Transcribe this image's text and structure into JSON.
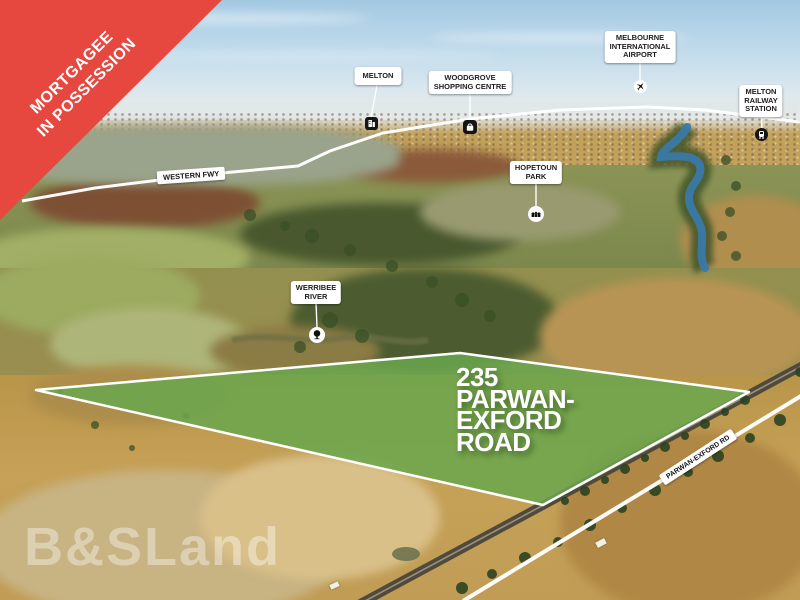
{
  "banner": {
    "lines": [
      "MORTGAGEE",
      "IN POSSESSION"
    ],
    "color": "#e64840"
  },
  "callouts": {
    "melton": {
      "lines": [
        "MELTON"
      ],
      "icon": "building-icon"
    },
    "woodgrove": {
      "lines": [
        "WOODGROVE",
        "SHOPPING CENTRE"
      ],
      "icon": "shopping-bag-icon"
    },
    "airport": {
      "lines": [
        "MELBOURNE",
        "INTERNATIONAL",
        "AIRPORT"
      ],
      "icon": "airplane-icon"
    },
    "melton_railway": {
      "lines": [
        "MELTON",
        "RAILWAY",
        "STATION"
      ],
      "icon": "train-icon"
    },
    "hopetoun_park": {
      "lines": [
        "HOPETOUN",
        "PARK"
      ],
      "icon": "houses-icon"
    },
    "werribee_river": {
      "lines": [
        "WERRIBEE",
        "RIVER"
      ],
      "icon": "tree-icon"
    }
  },
  "road_labels": {
    "western_fwy": "WESTERN FWY",
    "parwan_exford": "PARWAN-EXFORD RD"
  },
  "property": {
    "address_lines": [
      "235",
      "PARWAN-",
      "EXFORD",
      "ROAD"
    ],
    "highlight_color": "#6aa74e",
    "boundary_color": "#ffffff"
  },
  "watermark": {
    "text": "B&SLand"
  }
}
